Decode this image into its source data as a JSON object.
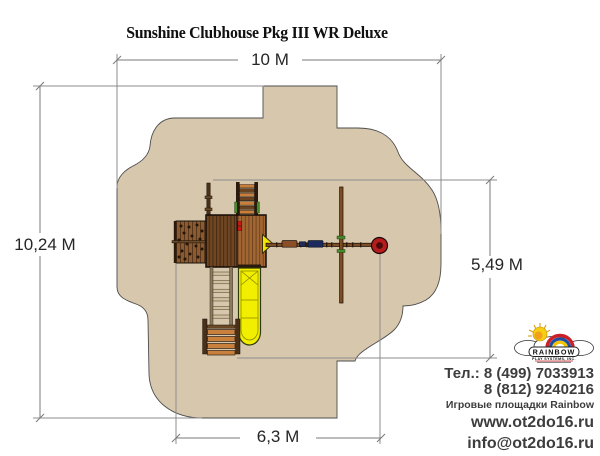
{
  "title": "Sunshine Clubhouse Pkg III WR Deluxe",
  "dimensions": {
    "overall_width": "10 M",
    "overall_depth": "10,24 M",
    "structure_depth": "5,49 M",
    "structure_width": "6,3 M"
  },
  "logo": {
    "brand": "RAINBOW",
    "subtitle": "PLAY SYSTEMS, INC."
  },
  "contact": {
    "phone_line1": "Тел.: 8 (499) 7033913",
    "phone_line2": "8 (812) 9240216",
    "caption": "Игровые площадки Rainbow",
    "website": "www.ot2do16.ru",
    "email": "info@ot2do16.ru"
  },
  "colors": {
    "safety_zone": "#d7c7ac",
    "zone_outline": "#4d4d4d",
    "dimension_line": "#8c8c8c",
    "label_text": "#262626",
    "wood_light": "#a26632",
    "wood_dark": "#6f4522",
    "wood_mid": "#8a5526",
    "slide_yellow": "#f2ee00",
    "tire_red": "#b51d1d",
    "swing_blue": "#1d2a5e",
    "accent_red": "#cc1616",
    "handle_green": "#4a8a2a",
    "logo_red": "#cc2027",
    "logo_blue": "#1f4da0",
    "logo_yellow": "#f5c400",
    "sun_yellow": "#f7cf12"
  }
}
